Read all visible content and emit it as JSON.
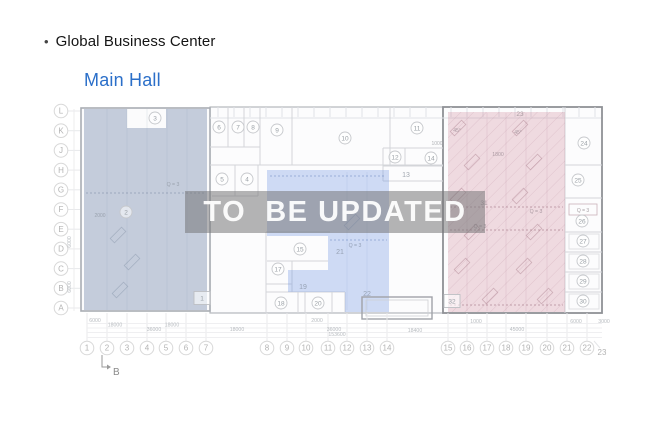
{
  "header": {
    "bullet": "•",
    "title": "Global Business Center"
  },
  "subtitle": {
    "label": "Main Hall",
    "color": "#2b6fc9"
  },
  "watermark": {
    "text": "TO  BE UPDATED"
  },
  "colors": {
    "region_left": "rgba(108,130,165,0.38)",
    "region_middle": "rgba(120,155,225,0.35)",
    "region_right": "rgba(205,128,152,0.28)",
    "hatch": "rgba(170,115,135,0.22)"
  },
  "plan": {
    "row_labels": [
      "L",
      "K",
      "J",
      "H",
      "G",
      "F",
      "E",
      "D",
      "C",
      "B",
      "A"
    ],
    "col_labels": [
      {
        "n": "1",
        "x": 87
      },
      {
        "n": "2",
        "x": 107
      },
      {
        "n": "3",
        "x": 127
      },
      {
        "n": "4",
        "x": 147
      },
      {
        "n": "5",
        "x": 166
      },
      {
        "n": "6",
        "x": 186
      },
      {
        "n": "7",
        "x": 206
      },
      {
        "n": "8",
        "x": 267
      },
      {
        "n": "9",
        "x": 287
      },
      {
        "n": "10",
        "x": 306
      },
      {
        "n": "11",
        "x": 328
      },
      {
        "n": "12",
        "x": 347
      },
      {
        "n": "13",
        "x": 367
      },
      {
        "n": "14",
        "x": 387
      },
      {
        "n": "15",
        "x": 448
      },
      {
        "n": "16",
        "x": 467
      },
      {
        "n": "17",
        "x": 487
      },
      {
        "n": "18",
        "x": 506
      },
      {
        "n": "19",
        "x": 526
      },
      {
        "n": "20",
        "x": 547
      },
      {
        "n": "21",
        "x": 567
      },
      {
        "n": "22",
        "x": 587
      }
    ],
    "col_23": {
      "n": "23",
      "x": 602,
      "y": 352
    },
    "rooms_circled": [
      {
        "n": "2",
        "x": 126,
        "y": 212
      },
      {
        "n": "3",
        "x": 155,
        "y": 118
      },
      {
        "n": "4",
        "x": 247,
        "y": 179
      },
      {
        "n": "5",
        "x": 222,
        "y": 179
      },
      {
        "n": "6",
        "x": 219,
        "y": 127
      },
      {
        "n": "7",
        "x": 238,
        "y": 127
      },
      {
        "n": "8",
        "x": 253,
        "y": 127
      },
      {
        "n": "9",
        "x": 277,
        "y": 130
      },
      {
        "n": "10",
        "x": 345,
        "y": 138
      },
      {
        "n": "11",
        "x": 417,
        "y": 128
      },
      {
        "n": "12",
        "x": 395,
        "y": 157
      },
      {
        "n": "14",
        "x": 431,
        "y": 158
      },
      {
        "n": "15",
        "x": 300,
        "y": 249
      },
      {
        "n": "17",
        "x": 278,
        "y": 269
      },
      {
        "n": "18",
        "x": 281,
        "y": 303
      },
      {
        "n": "20",
        "x": 318,
        "y": 303
      },
      {
        "n": "24",
        "x": 584,
        "y": 143
      },
      {
        "n": "25",
        "x": 578,
        "y": 180
      },
      {
        "n": "26",
        "x": 582,
        "y": 221
      },
      {
        "n": "27",
        "x": 583,
        "y": 241
      },
      {
        "n": "28",
        "x": 583,
        "y": 261
      },
      {
        "n": "29",
        "x": 583,
        "y": 281
      },
      {
        "n": "30",
        "x": 583,
        "y": 301
      }
    ],
    "rooms_boxed": [
      {
        "n": "1",
        "x": 202,
        "y": 298
      },
      {
        "n": "32",
        "x": 452,
        "y": 301
      }
    ],
    "text_labels": [
      {
        "t": "13",
        "x": 406,
        "y": 177,
        "s": 7,
        "c": "#a2a8b0"
      },
      {
        "t": "19",
        "x": 303,
        "y": 289,
        "s": 7,
        "c": "#97a2b4"
      },
      {
        "t": "21",
        "x": 340,
        "y": 254,
        "s": 7,
        "c": "#97a2b4"
      },
      {
        "t": "22",
        "x": 367,
        "y": 296,
        "s": 7,
        "c": "#97a2b4"
      },
      {
        "t": "31",
        "x": 484,
        "y": 205,
        "s": 6.5,
        "c": "#ab9aa2"
      },
      {
        "t": "23",
        "x": 520,
        "y": 116,
        "s": 6.5,
        "c": "#a89ba1"
      },
      {
        "t": "Q = 3",
        "x": 173,
        "y": 186,
        "s": 5.2,
        "c": "#9aa2ae"
      },
      {
        "t": "Q = 3",
        "x": 355,
        "y": 247,
        "s": 5.2,
        "c": "#93a0b6"
      },
      {
        "t": "Q = 3",
        "x": 480,
        "y": 228,
        "s": 5.2,
        "c": "#ab9aa2"
      },
      {
        "t": "Q = 3",
        "x": 536,
        "y": 213,
        "s": 5.2,
        "c": "#ab9aa2"
      },
      {
        "t": "Q = 3",
        "x": 583,
        "y": 212,
        "s": 5,
        "c": "#a8a0a4"
      },
      {
        "t": "45°",
        "x": 457,
        "y": 132,
        "s": 5,
        "c": "#ab9aa2"
      },
      {
        "t": "45°",
        "x": 518,
        "y": 134,
        "s": 5,
        "c": "#ab9aa2"
      },
      {
        "t": "1800",
        "x": 498,
        "y": 156,
        "s": 5.2,
        "c": "#ab9aa2"
      },
      {
        "t": "1000",
        "x": 437,
        "y": 145,
        "s": 5,
        "c": "#b0b2b6"
      },
      {
        "t": "2000",
        "x": 100,
        "y": 217,
        "s": 5,
        "c": "#9aa2ae"
      }
    ],
    "dim_labels": [
      {
        "t": "6000",
        "x": 95,
        "y": 322
      },
      {
        "t": "2000",
        "x": 317,
        "y": 322
      },
      {
        "t": "1000",
        "x": 476,
        "y": 323
      },
      {
        "t": "6000",
        "x": 576,
        "y": 323
      },
      {
        "t": "3000",
        "x": 604,
        "y": 323
      },
      {
        "t": "18000",
        "x": 115,
        "y": 326.5
      },
      {
        "t": "18000",
        "x": 172,
        "y": 326.5
      },
      {
        "t": "36000",
        "x": 154,
        "y": 331
      },
      {
        "t": "18000",
        "x": 237,
        "y": 331
      },
      {
        "t": "36000",
        "x": 334,
        "y": 331
      },
      {
        "t": "18400",
        "x": 415,
        "y": 332
      },
      {
        "t": "45000",
        "x": 517,
        "y": 331
      },
      {
        "t": "153600",
        "x": 337,
        "y": 336
      }
    ],
    "dim_labels_vertical": [
      {
        "t": "6000",
        "x": 71,
        "y": 242
      },
      {
        "t": "6000",
        "x": 71,
        "y": 287
      }
    ],
    "parking_marks": {
      "pink": [
        [
          458,
          128
        ],
        [
          472,
          162
        ],
        [
          458,
          196
        ],
        [
          472,
          232
        ],
        [
          462,
          266
        ],
        [
          520,
          128
        ],
        [
          534,
          162
        ],
        [
          520,
          196
        ],
        [
          534,
          232
        ],
        [
          524,
          266
        ],
        [
          490,
          296
        ],
        [
          545,
          296
        ]
      ],
      "left": [
        [
          118,
          235
        ],
        [
          132,
          262
        ],
        [
          120,
          290
        ]
      ],
      "middle": [
        [
          352,
          222
        ]
      ]
    },
    "section_marker": {
      "label": "B"
    }
  }
}
